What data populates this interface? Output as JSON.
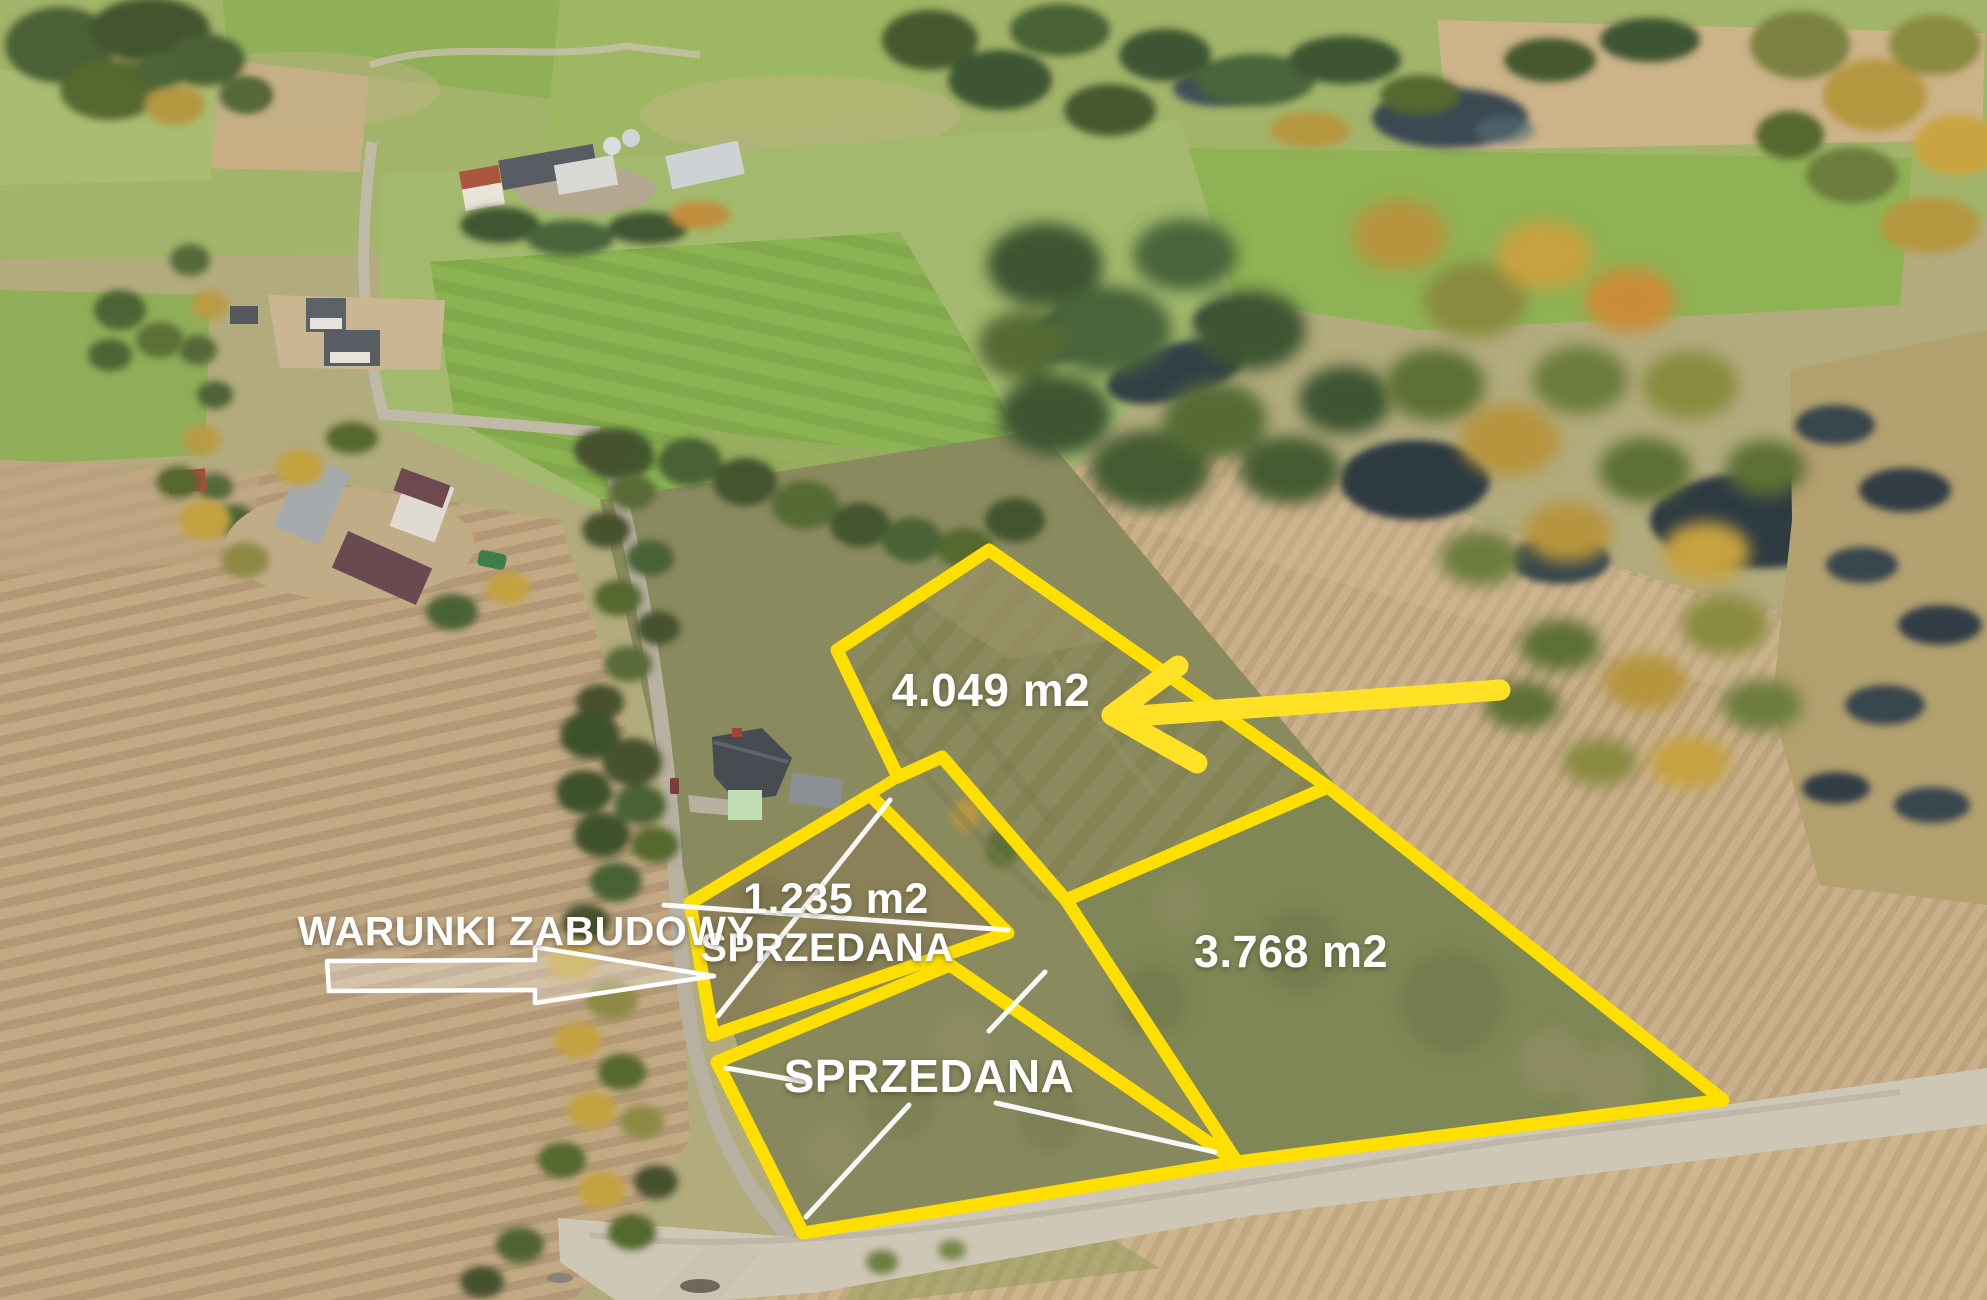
{
  "plots": [
    {
      "id": "plot-4049",
      "area_label": "4.049 m2"
    },
    {
      "id": "plot-1235",
      "area_label": "1.235 m2",
      "status_label": "SPRZEDANA"
    },
    {
      "id": "plot-sold-bottom",
      "status_label": "SPRZEDANA"
    },
    {
      "id": "plot-3768",
      "area_label": "3.768 m2"
    }
  ],
  "callout": {
    "label": "WARUNKI ZABUDOWY"
  },
  "icons": {
    "direction_arrow": "arrow-left-icon",
    "callout_arrow": "arrow-right-icon"
  },
  "colors": {
    "outline": "#ffdf00",
    "arrow": "#ffe126",
    "text": "#ffffff",
    "pointer": "#ffffff"
  }
}
